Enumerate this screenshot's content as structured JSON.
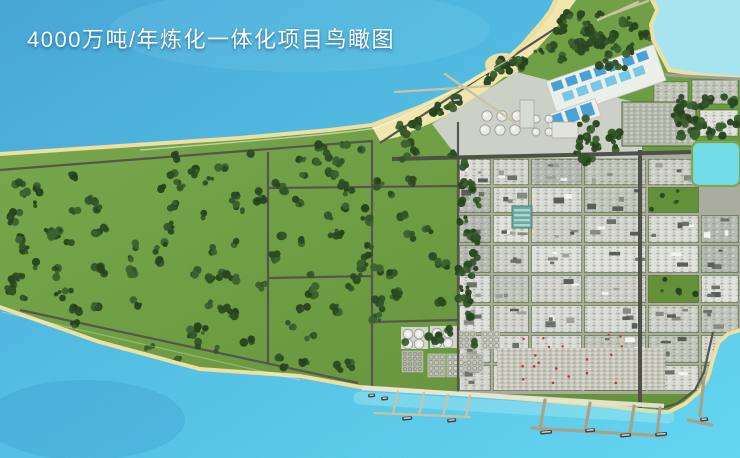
{
  "title": "4000万吨/年炼化一体化项目鸟瞰图",
  "colors": {
    "title_color": "#ffffff",
    "water_deep": "#2e9ad0",
    "water_mid": "#3ab4de",
    "water_shallow": "#4ed0ee",
    "water_pale": "#a5e6ef",
    "sand": "#eedfa2",
    "beach_bright": "#f2e5ae",
    "grass_light": "#7cab50",
    "grass_dark": "#639039",
    "zone_base": "#a9ac9e",
    "platform": "#cdd0c6",
    "slab": "#eceee9",
    "parking": "#b4b7ac",
    "lagoon": "#72dce8",
    "pool_dark": "#4aa2d4",
    "pool_light": "#76c8e4",
    "road": "#55574e",
    "road_major": "#4e5049",
    "pier": "#c9c2a4",
    "pier_dark": "#aaa287",
    "seawall": "#e8e5d6",
    "tank_fill": "#e9eae6",
    "tank_stroke": "#9c9e97",
    "tank_gray": "#c2c4b9",
    "laydown": "#c7c6bb",
    "accent_red": "#b5402c",
    "ship_hull": "#39434b",
    "ship_deck": "#d9dbd6",
    "verge_green": "#4d6530",
    "tree_dark": "#2e4f25"
  },
  "palettes": {
    "plot_shades": [
      "#d9dad3",
      "#cfd1c8",
      "#c2c5ba",
      "#dfe0da",
      "#b7bab0",
      "#d3d4cc"
    ],
    "tree_shades": [
      "#33542a",
      "#2b4a23",
      "#3d6130",
      "#27421f"
    ],
    "structure_shades": [
      "#f4f4f0",
      "#6d7168",
      "#868a80",
      "#5a5e56",
      "#9da198"
    ]
  }
}
